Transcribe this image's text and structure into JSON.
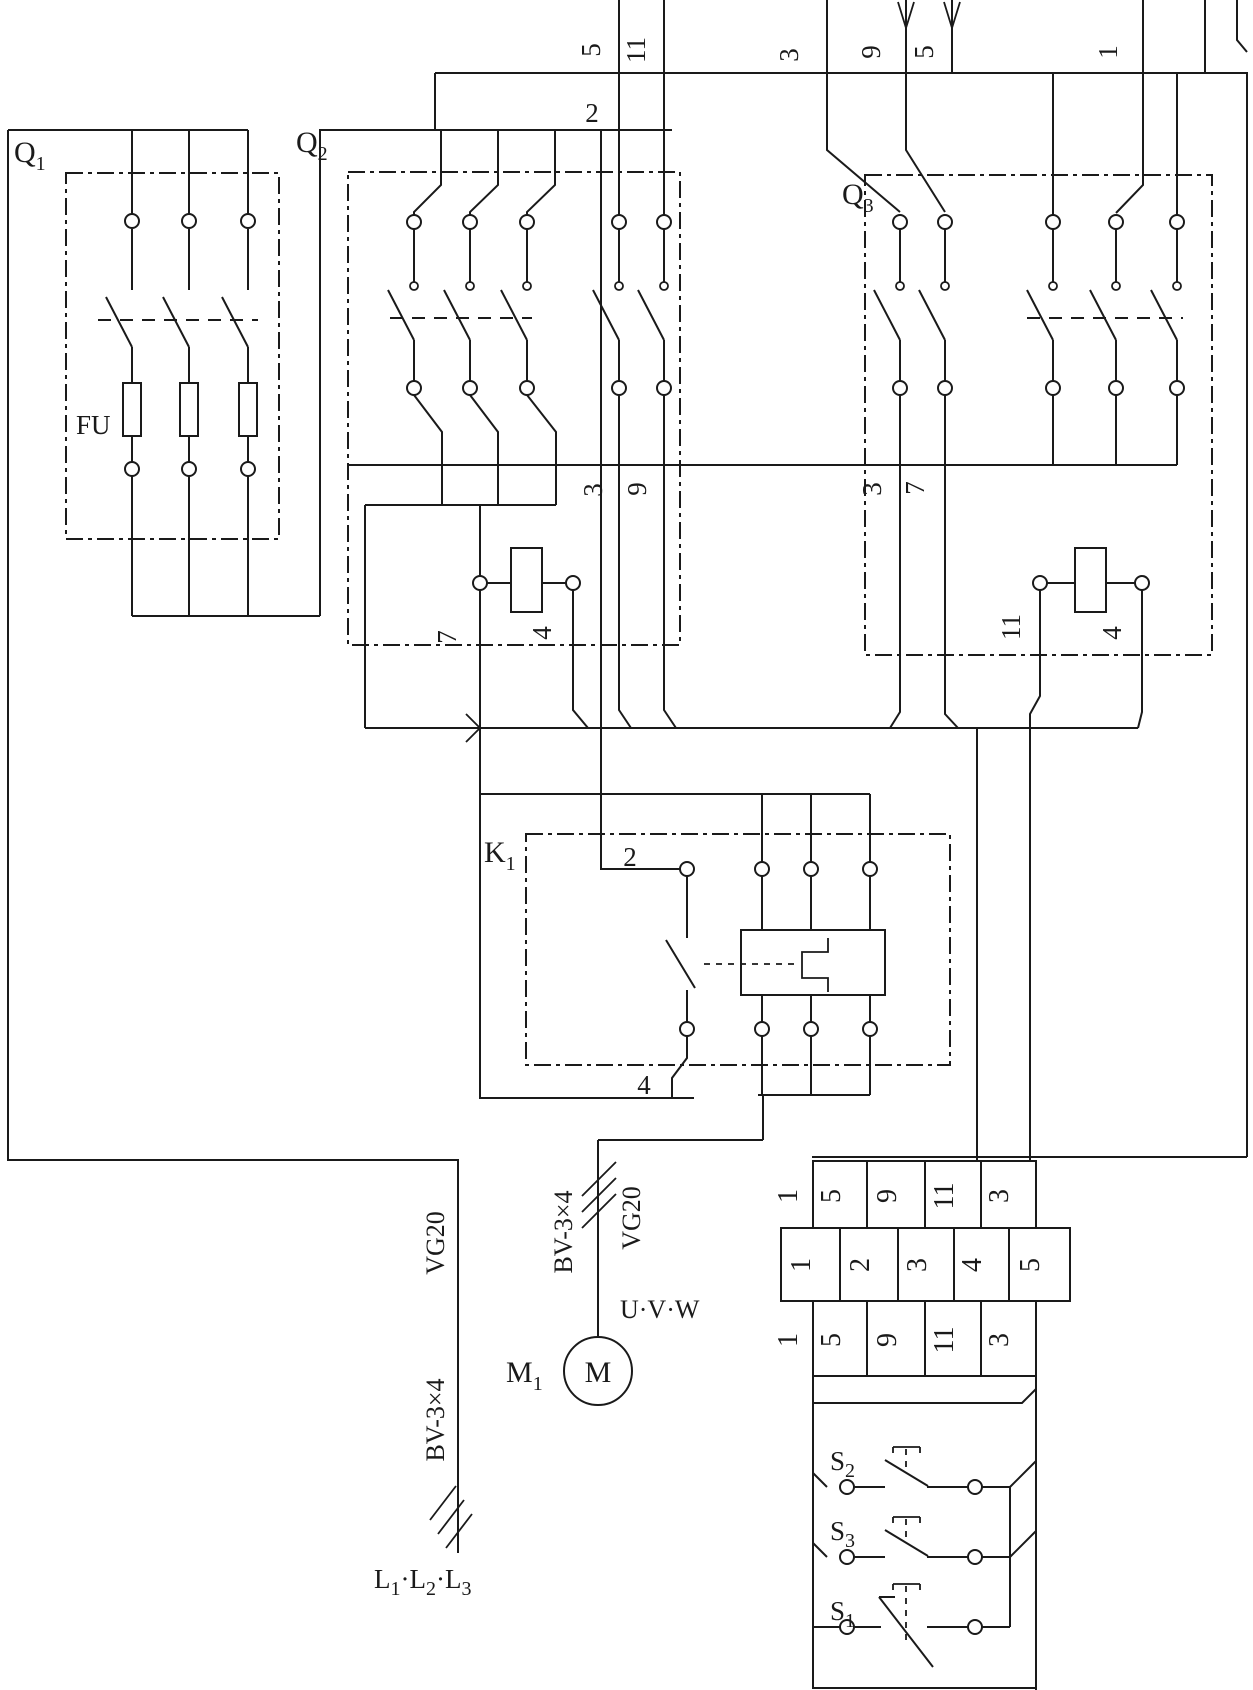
{
  "colors": {
    "ink": "#1a1a1a",
    "background": "#ffffff"
  },
  "blocks": {
    "q1": {
      "main": "Q",
      "sub": "1"
    },
    "q2": {
      "main": "Q",
      "sub": "2"
    },
    "q3": {
      "main": "Q",
      "sub": "3"
    },
    "k1": {
      "main": "K",
      "sub": "1"
    },
    "m1": {
      "main": "M",
      "sub": "1"
    },
    "motor": "M",
    "fuse": "FU",
    "s2": {
      "main": "S",
      "sub": "2"
    },
    "s3": {
      "main": "S",
      "sub": "3"
    },
    "s1": {
      "main": "S",
      "sub": "1"
    }
  },
  "wire_numbers": {
    "top_5": "5",
    "top_11": "11",
    "top_2": "2",
    "top_3": "3",
    "top_9": "9",
    "top_5b": "5",
    "top_1": "1",
    "q2_coil_7": "7",
    "q2_coil_4": "4",
    "q2_aux_3": "3",
    "q2_aux_9": "9",
    "q3_aux_3": "3",
    "q3_aux_7": "7",
    "q3_coil_11": "11",
    "q3_coil_4": "4",
    "k1_2": "2",
    "k1_4": "4"
  },
  "cables": {
    "incoming_conduit": "VG20",
    "incoming_cable": "BV-3×4",
    "motor_cable": "BV-3×4",
    "motor_conduit": "VG20",
    "motor_terminals": "U·V·W",
    "supply": {
      "p1": "L",
      "s1": "1",
      "p2": "·L",
      "s2": "2",
      "p3": "·L",
      "s3": "3"
    }
  },
  "terminal_strip": {
    "row_top": {
      "prefix": "1",
      "cells": [
        "5",
        "9",
        "11",
        "3"
      ]
    },
    "row_middle": {
      "cells": [
        "1",
        "2",
        "3",
        "4",
        "5"
      ]
    },
    "row_bottom": {
      "prefix": "1",
      "cells": [
        "5",
        "9",
        "11",
        "3"
      ]
    }
  }
}
